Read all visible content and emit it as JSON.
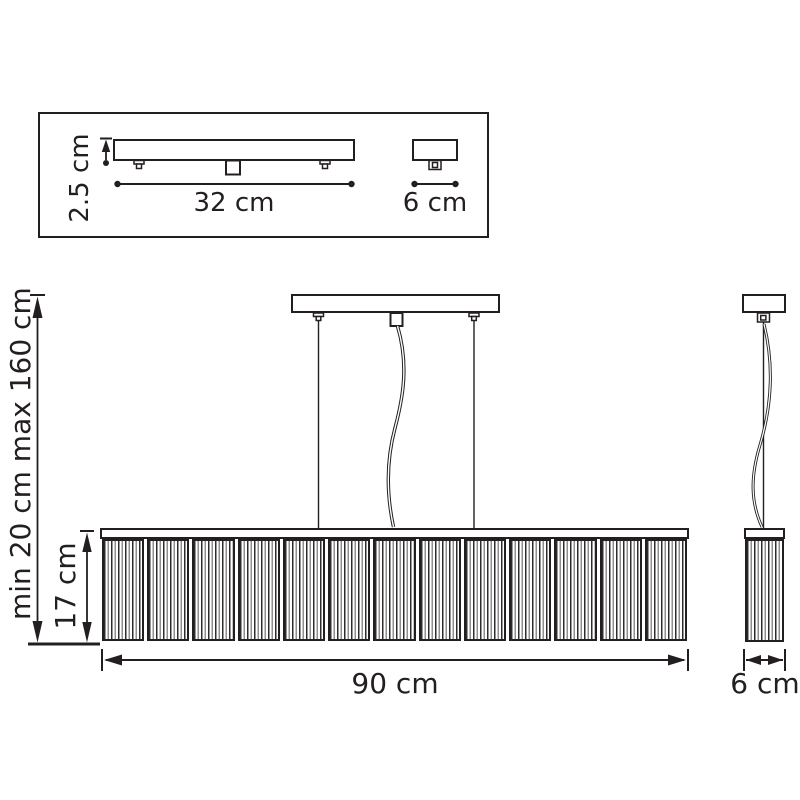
{
  "colors": {
    "line": "#231f20",
    "background": "#ffffff",
    "stripe_dark": "#2d2d2d",
    "stripe_gray": "#8f8f8f"
  },
  "mounting_detail": {
    "plate_height_label": "2.5 cm",
    "plate_width_label": "32 cm",
    "small_plate_width_label": "6 cm"
  },
  "front_view": {
    "suspension_height_label": "min 20 cm max 160 cm",
    "shade_height_label": "17 cm",
    "shade_width_label": "90 cm",
    "panel_count": 13
  },
  "side_view": {
    "shade_depth_label": "6 cm"
  }
}
